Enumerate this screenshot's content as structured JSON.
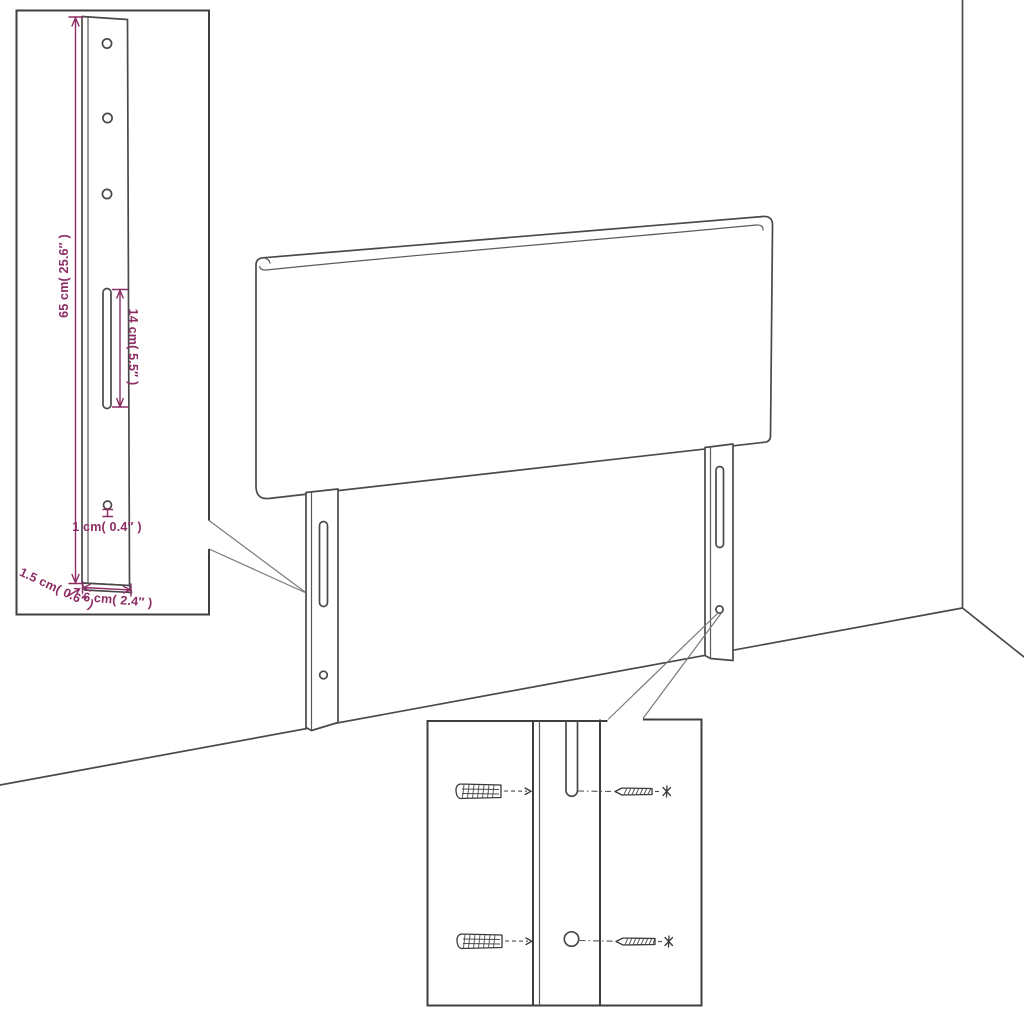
{
  "page": {
    "background": "#ffffff",
    "description": "Technical assembly diagram of an upholstered headboard with two slotted mounting legs, a magnified leg/bracket detail inset with dimensions, and a magnified wall-fixing inset showing screws and wall plugs"
  },
  "colors": {
    "line": "#4a4a4a",
    "box_border": "#3f3f3f",
    "dimension_accent": "#8c2d64"
  },
  "bracket_inset": {
    "hole_count": 3,
    "labels": {
      "height": "65 cm( 25.6″ )",
      "slot_length": "14 cm( 5.5″ )",
      "hole_diameter": "1 cm( 0.4″ )",
      "thickness": "1.5 cm( 0.6″ )",
      "width": "6 cm( 2.4″ )"
    }
  },
  "fixing_inset": {
    "wall_plug_count": 2,
    "screw_count": 2
  }
}
